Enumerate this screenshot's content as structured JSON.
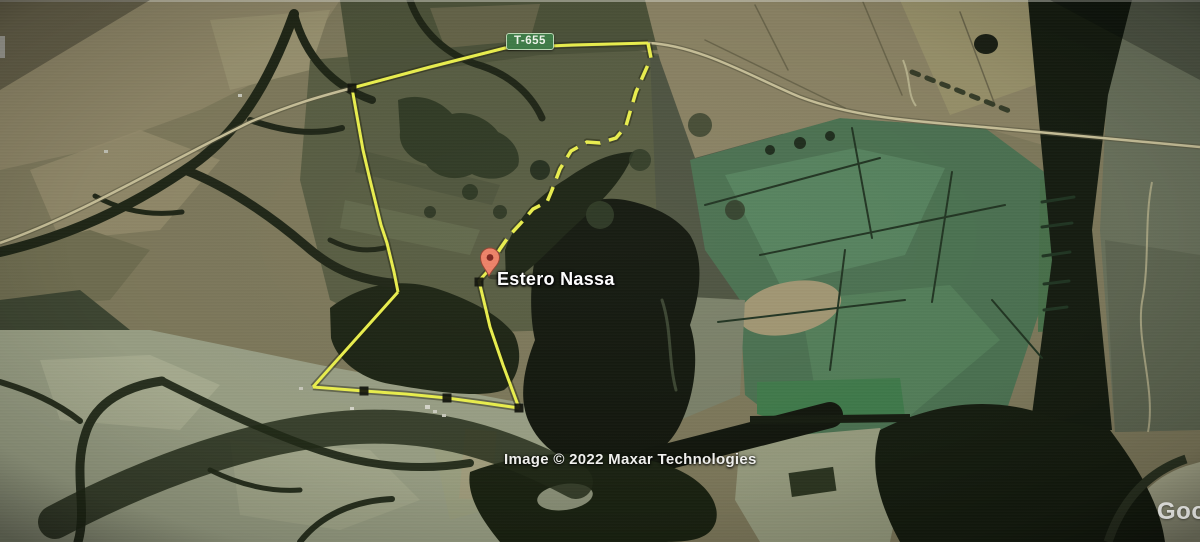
{
  "map": {
    "road_sign_label": "T-655",
    "placemark_label": "Estero Nassa",
    "attribution": "Image © 2022 Maxar Technologies",
    "google_watermark": "Goog",
    "colors": {
      "boundary_yellow": "#e9ee4b",
      "boundary_shadow": "#1c1e08",
      "sign_green": "#3c7a45",
      "sign_border": "#b9d6b2",
      "pin_body": "#ee8066",
      "pin_hole": "#7c231c",
      "road_pale": "#c9c199"
    },
    "boundary": {
      "solid_segments": [
        "352,88 430,67 505,48 572,45 648,43",
        "352,88 363,150 370,180 381,225 387,243 394,272 398,292",
        "398,292 355,340 313,387",
        "313,387 364,391 406,394 447,398 484,403 519,408",
        "494,264 479,281 486,310 490,327 503,365 519,408"
      ],
      "dashed_segment": "648,43 651,58 643,76 636,92 630,112 626,126 616,138 600,143 587,142 571,151 560,169 552,190 547,202 533,209 521,223 509,236 500,249 494,259",
      "handles": [
        [
          352,
          88
        ],
        [
          479,
          282
        ],
        [
          364,
          391
        ],
        [
          447,
          398
        ],
        [
          519,
          408
        ]
      ]
    }
  }
}
